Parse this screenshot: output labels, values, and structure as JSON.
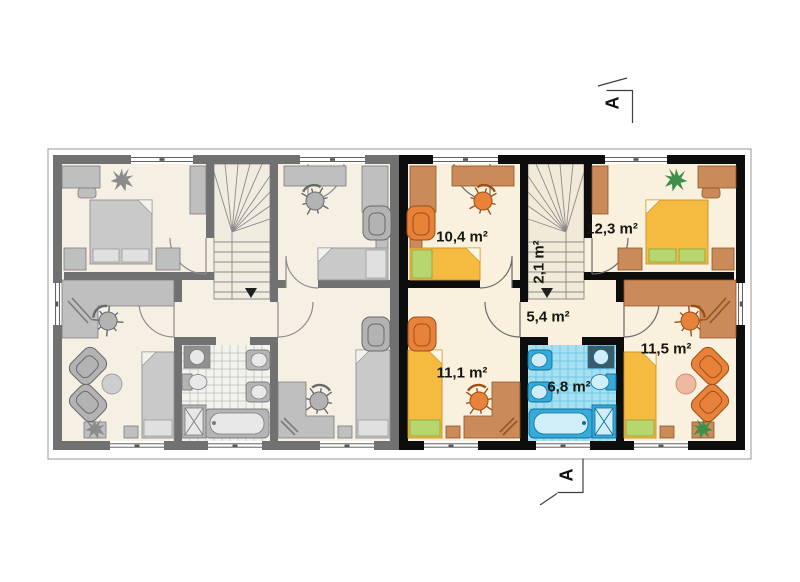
{
  "plan": {
    "rooms": [
      {
        "id": "bedroom-top-left",
        "area_label": "10,4 m²"
      },
      {
        "id": "staircase",
        "area_label": "2,1 m²"
      },
      {
        "id": "bedroom-top-right",
        "area_label": "12,3 m²"
      },
      {
        "id": "hallway",
        "area_label": "5,4 m²"
      },
      {
        "id": "bedroom-bottom-left",
        "area_label": "11,1 m²"
      },
      {
        "id": "bathroom",
        "area_label": "6,8 m²"
      },
      {
        "id": "sitting-room-bottom-right",
        "area_label": "11,5 m²"
      }
    ],
    "section_markers": {
      "top": "A",
      "bottom": "A"
    },
    "colors": {
      "wall_right_unit": "#0d0d0d",
      "wall_left_unit": "#717171",
      "floor": "#f9f1dd",
      "furniture_wood": "#cb8a59",
      "furniture_orange": "#e8813a",
      "bed_yellow": "#f5bb41",
      "pillow_green": "#b7d66f",
      "bathroom_blue": "#36aad8",
      "bathroom_tile": "#a6dff0"
    }
  }
}
